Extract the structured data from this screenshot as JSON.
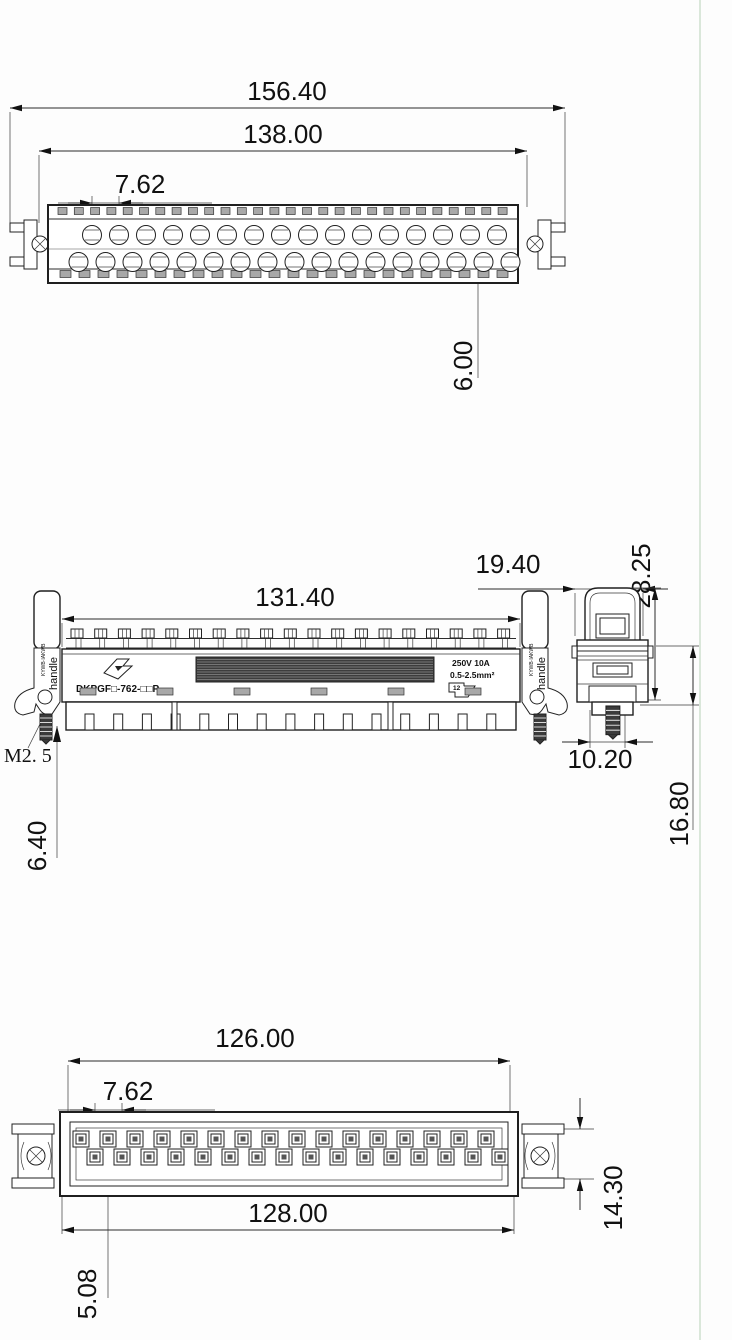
{
  "drawing": {
    "top_view": {
      "dim_overall_width": "156.40",
      "dim_mounting_width": "138.00",
      "dim_contact_pitch": "7.62",
      "dim_pin_inset": "6.00"
    },
    "front_view": {
      "dim_body_width": "131.40",
      "dim_end_width": "19.40",
      "dim_total_height": "28.25",
      "dim_screw_thread": "M2. 5",
      "dim_screw_length": "6.40",
      "dim_end_depth": "10.20",
      "dim_body_height": "16.80",
      "part_number": "DKPGF□-762-□□P",
      "rating_line1": "250V 10A",
      "rating_line2": "0.5-2.5mm²",
      "lever_brand": "KYWB·IAKWB",
      "lever_label": "handle",
      "cert_text": "12"
    },
    "bottom_view": {
      "dim_contact_span": "126.00",
      "dim_contact_pitch": "7.62",
      "dim_mounting_span": "128.00",
      "dim_row_offset": "5.08",
      "dim_body_height": "14.30"
    }
  }
}
